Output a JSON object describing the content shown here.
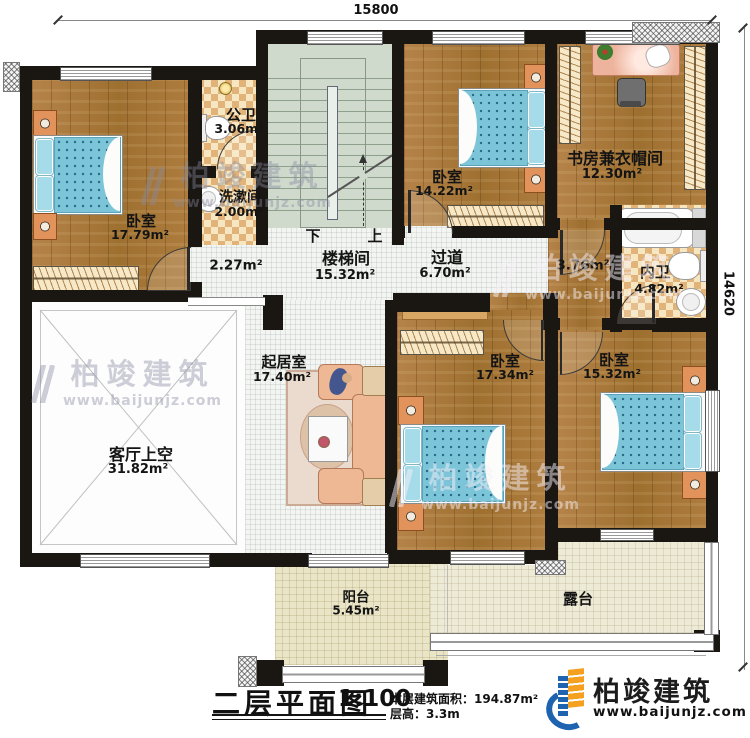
{
  "title_block": {
    "plan_title": "二层平面图",
    "scale": "1:100",
    "area_label": "本层建筑面积：",
    "area_value": "194.87m²",
    "height_label": "层高：",
    "height_value": "3.3m"
  },
  "dimensions": {
    "top": "15800",
    "right": "14620"
  },
  "stairs": {
    "down": "下",
    "up": "上"
  },
  "rooms": {
    "bedroom_nw": {
      "name": "卧室",
      "area": "17.79m²"
    },
    "public_bath": {
      "name": "公卫",
      "area": "3.06m²"
    },
    "wash": {
      "name": "洗漱间",
      "area": "2.00m²"
    },
    "stair": {
      "name": "楼梯间",
      "area": "15.32m²"
    },
    "hall": {
      "area": "2.27m²"
    },
    "bedroom_n": {
      "name": "卧室",
      "area": "14.22m²"
    },
    "study": {
      "name": "书房兼衣帽间",
      "area": "12.30m²"
    },
    "bath_inner": {
      "name": "内卫",
      "area": "4.82m²"
    },
    "corridor": {
      "name": "过道",
      "area": "6.70m²"
    },
    "corridor_e": {
      "area": "3.76m²"
    },
    "living": {
      "name": "起居室",
      "area": "17.40m²"
    },
    "void": {
      "name": "客厅上空",
      "area": "31.82m²"
    },
    "bedroom_s": {
      "name": "卧室",
      "area": "17.34m²"
    },
    "bedroom_se": {
      "name": "卧室",
      "area": "15.32m²"
    },
    "balcony": {
      "name": "阳台",
      "area": "5.45m²"
    },
    "terrace": {
      "name": "露台"
    }
  },
  "watermark": {
    "brand": "柏竣建筑",
    "url": "www.baijunjz.com"
  },
  "logo": {
    "brand": "柏竣建筑",
    "url": "www.baijunjz.com"
  }
}
